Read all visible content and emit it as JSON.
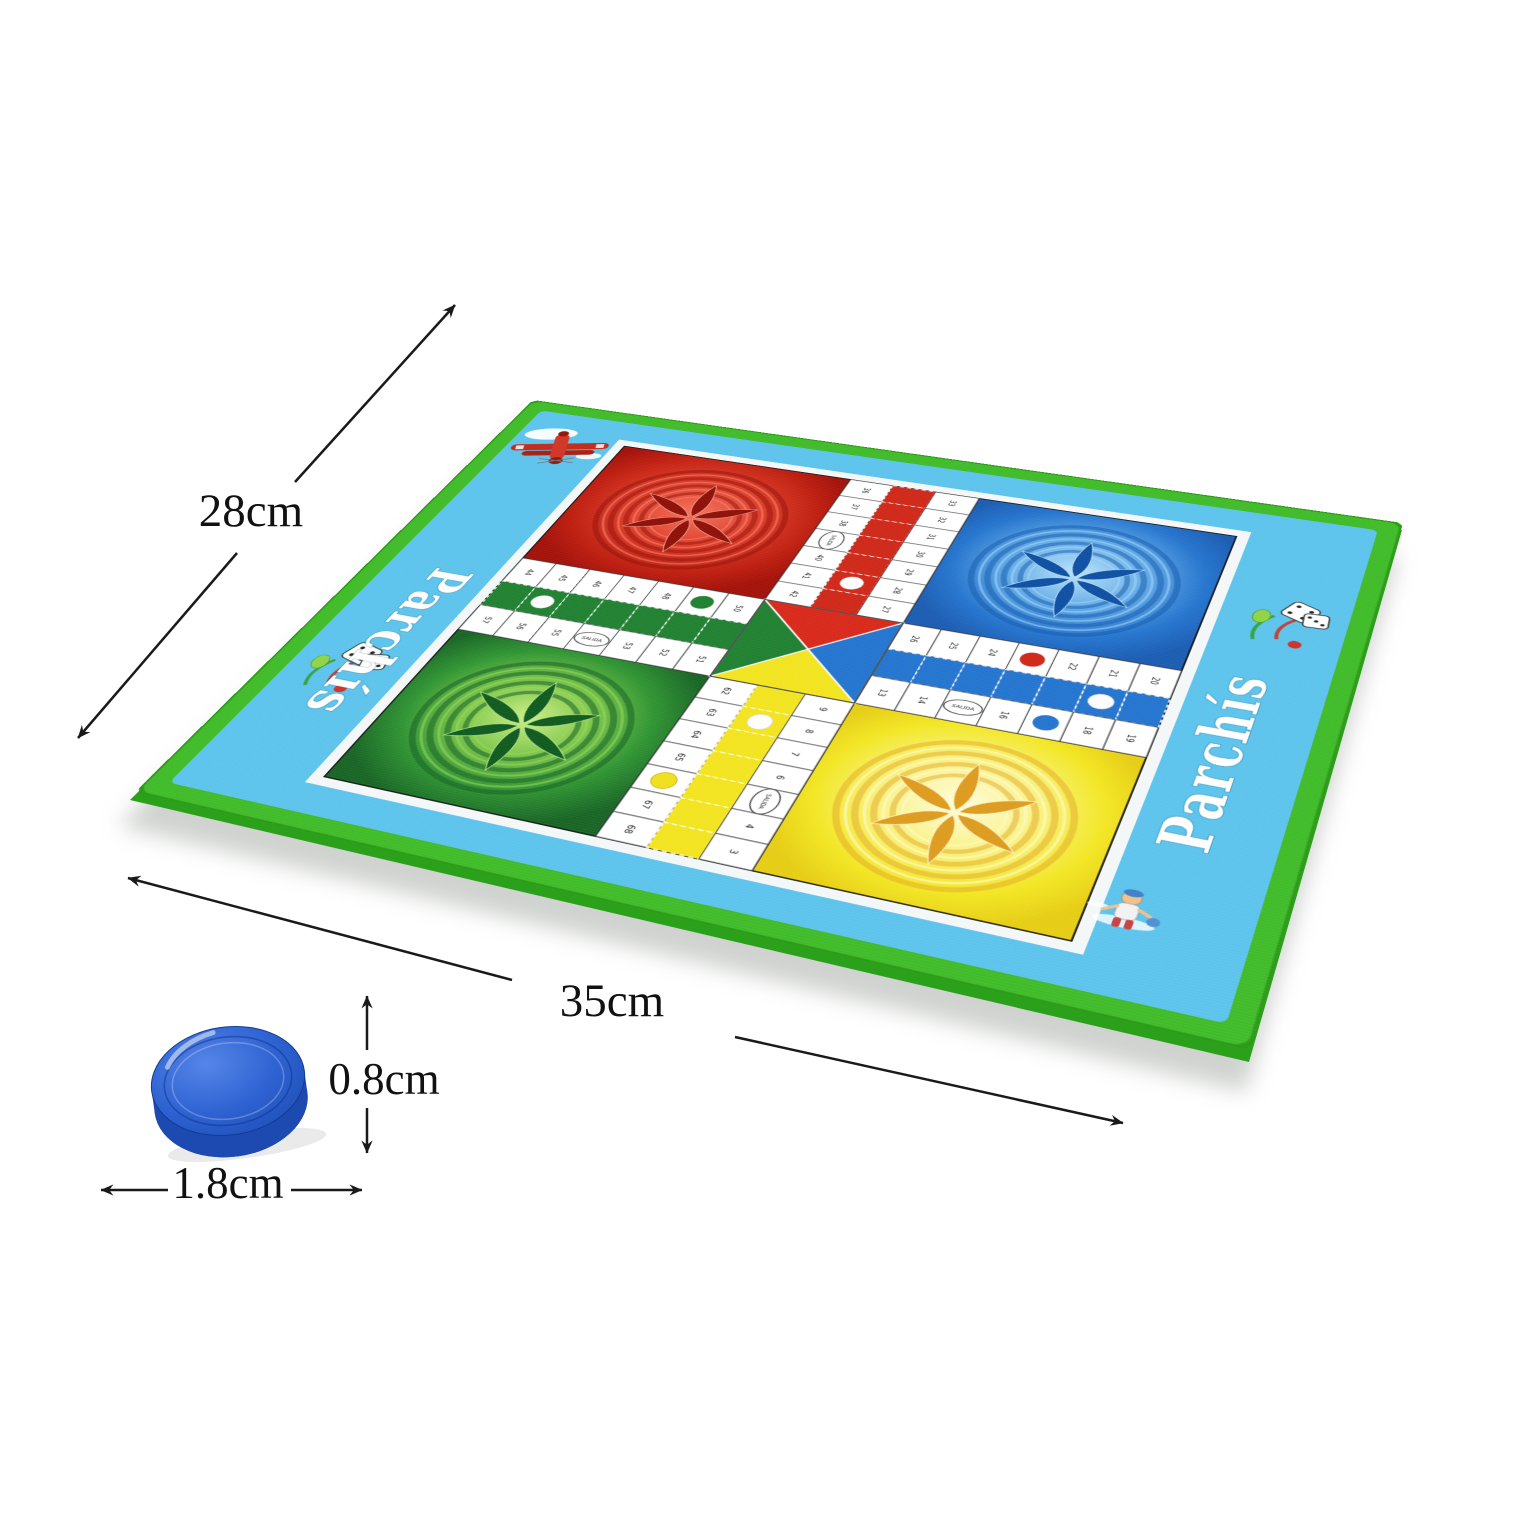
{
  "scene": {
    "background_color": "#ffffff",
    "description": "Parchis fabric game mat product photo with dimension annotations and one blue token"
  },
  "dimensions": {
    "mat_length": "35cm",
    "mat_width": "28cm",
    "piece_height": "0.8cm",
    "piece_diameter": "1.8cm"
  },
  "mat": {
    "brand_left": "Parchís",
    "brand_right": "Parchís",
    "salida_label": "SALIDA",
    "colors": {
      "border_green": "#3fbb28",
      "margin_blue": "#5cc3ec",
      "red": "#cf2718",
      "blue": "#2374cf",
      "green": "#1f8030",
      "yellow": "#f2e41e"
    },
    "cell_numbers": {
      "top_left_col": [
        "36",
        "37",
        "38",
        "",
        "40",
        "41",
        "42"
      ],
      "top_right_col": [
        "33",
        "32",
        "31",
        "30",
        "29",
        "28",
        "27"
      ],
      "right_top_row": [
        "26",
        "25",
        "24",
        "",
        "22",
        "21",
        "20"
      ],
      "right_bottom_row": [
        "13",
        "14",
        "",
        "16",
        "",
        "18",
        "19"
      ],
      "bottom_right_col": [
        "9",
        "8",
        "7",
        "6",
        "",
        "4",
        "3"
      ],
      "bottom_left_col": [
        "62",
        "63",
        "64",
        "65",
        "",
        "67",
        "68"
      ],
      "left_top_row": [
        "44",
        "45",
        "46",
        "47",
        "48",
        "",
        "50"
      ],
      "left_bottom_row": [
        "57",
        "56",
        "55",
        "",
        "53",
        "52",
        "51"
      ]
    },
    "illustrations": [
      "biplane",
      "flying-dice",
      "flying-dice",
      "swimmer-kid"
    ]
  },
  "piece": {
    "color": "#2b5fd0",
    "side_color": "#1c4ab0",
    "bottom_color": "#153f9b"
  }
}
